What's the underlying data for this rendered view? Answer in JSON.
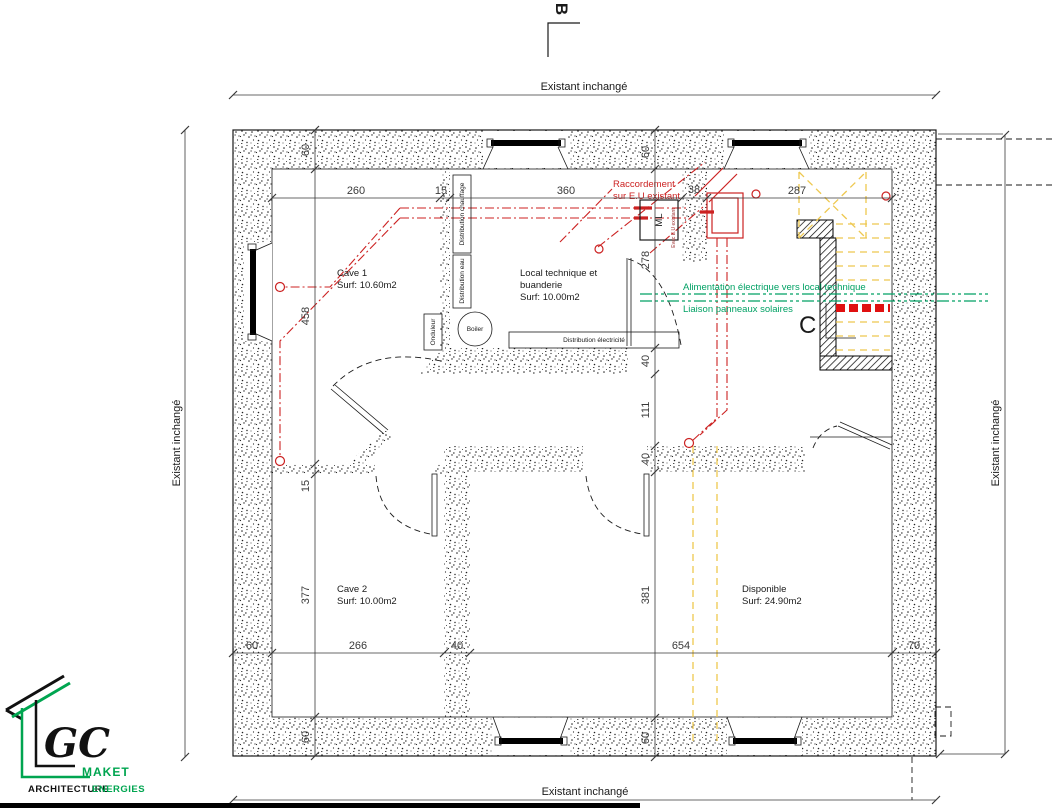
{
  "plan": {
    "boundary_top": "Existant inchangé",
    "boundary_bottom": "Existant inchangé",
    "boundary_left": "Existant inchangé",
    "boundary_right": "Existant inchangé",
    "section_b": "B",
    "section_c": "C"
  },
  "rooms": {
    "cave1": {
      "name": "Cave 1",
      "surface": "Surf: 10.60m2"
    },
    "local_technique": {
      "name_line1": "Local technique et",
      "name_line2": "buanderie",
      "surface": "Surf: 10.00m2"
    },
    "cave2": {
      "name": "Cave 2",
      "surface": "Surf: 10.00m2"
    },
    "disponible": {
      "name": "Disponible",
      "surface": "Surf: 24.90m2"
    }
  },
  "equipment": {
    "distribution_chauffage": "Distribution chauffage",
    "distribution_eau": "Distribution eau",
    "onduleur": "Onduleur",
    "boiler": "Boiler",
    "distribution_electricite": "Distribution électricité",
    "ml": "ML"
  },
  "notes": {
    "red_line1": "Raccordement",
    "red_line2": "sur E.U existant",
    "red_small_vertical": "Evac E.U existant",
    "green_line1": "Alimentation électrique vers local technique",
    "green_line2": "Liaison panneaux solaires"
  },
  "dims": {
    "top": [
      "260",
      "15",
      "360",
      "38",
      "287"
    ],
    "left": [
      "60",
      "458",
      "15",
      "377",
      "60"
    ],
    "middle": [
      "60",
      "278",
      "40",
      "111",
      "40",
      "381",
      "60"
    ],
    "bottom": [
      "60",
      "266",
      "40",
      "654",
      "70"
    ]
  },
  "logo": {
    "gc": "GC",
    "maket": "MAKET",
    "architecture": "ARCHITECTURE",
    "energies": "ENERGIES"
  },
  "colors": {
    "red": "#cc2222",
    "green": "#00a164",
    "yellow": "#eec84f",
    "logo-green": "#00a550"
  }
}
